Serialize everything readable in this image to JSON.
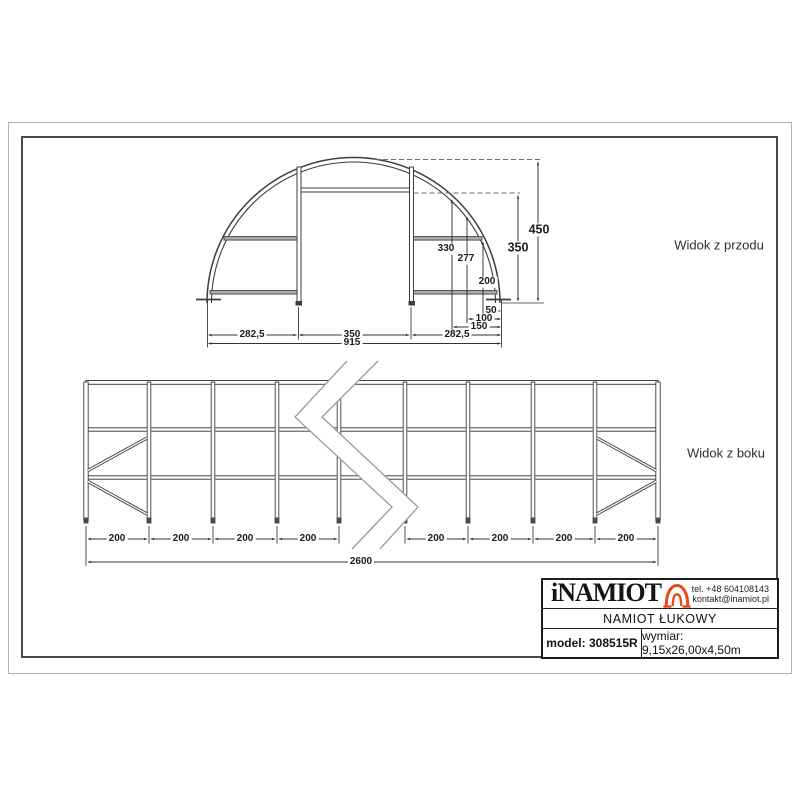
{
  "front_view": {
    "label": "Widok z przodu",
    "dim_height_total": "450",
    "dim_height_door": "350",
    "dim_h330": "330",
    "dim_h277": "277",
    "dim_h200": "200",
    "dim_w50": "50",
    "dim_w100": "100",
    "dim_w150": "150",
    "dim_left": "282,5",
    "dim_door": "350",
    "dim_right": "282,5",
    "dim_total": "915"
  },
  "side_view": {
    "label": "Widok z boku",
    "bays": [
      "200",
      "200",
      "200",
      "200",
      "200",
      "200",
      "200",
      "200"
    ],
    "dim_total": "2600"
  },
  "title_block": {
    "brand": "iNAMIOT",
    "logo_icon": "tent-arch-icon",
    "phone": "tel. +48 604108143",
    "email": "kontakt@inamiot.pl",
    "product_name": "NAMIOT ŁUKOWY",
    "model": "model: 308515R",
    "dimensions": "wymiar: 9,15x26,00x4,50m",
    "accent_color": "#e8491d"
  }
}
